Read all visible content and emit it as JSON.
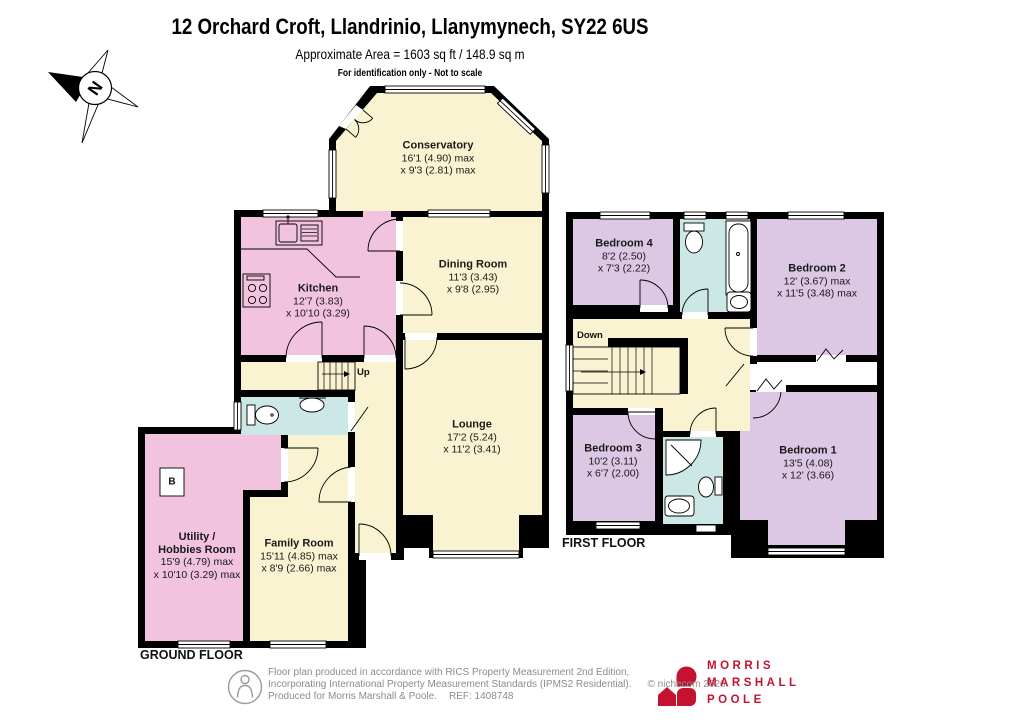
{
  "header": {
    "title": "12 Orchard Croft, Llandrinio, Llanymynech, SY22 6US",
    "area_line": "Approximate Area = 1603 sq ft / 148.9 sq m",
    "note": "For identification only - Not to scale"
  },
  "compass": {
    "label": "N"
  },
  "ground_floor": {
    "label": "GROUND FLOOR",
    "stairs_label": "Up",
    "boiler_label": "B",
    "rooms": {
      "conservatory": {
        "name": "Conservatory",
        "line1": "16'1 (4.90) max",
        "line2": "x 9'3 (2.81) max"
      },
      "kitchen": {
        "name": "Kitchen",
        "line1": "12'7 (3.83)",
        "line2": "x 10'10 (3.29)"
      },
      "dining_room": {
        "name": "Dining Room",
        "line1": "11'3 (3.43)",
        "line2": "x 9'8 (2.95)"
      },
      "lounge": {
        "name": "Lounge",
        "line1": "17'2 (5.24)",
        "line2": "x 11'2 (3.41)"
      },
      "utility_hobbies": {
        "name1": "Utility /",
        "name2": "Hobbies Room",
        "line1": "15'9 (4.79) max",
        "line2": "x 10'10 (3.29) max"
      },
      "family_room": {
        "name": "Family Room",
        "line1": "15'11 (4.85) max",
        "line2": "x 8'9 (2.66) max"
      }
    }
  },
  "first_floor": {
    "label": "FIRST FLOOR",
    "stairs_label": "Down",
    "rooms": {
      "bedroom_4": {
        "name": "Bedroom 4",
        "line1": "8'2 (2.50)",
        "line2": "x 7'3 (2.22)"
      },
      "bedroom_2": {
        "name": "Bedroom 2",
        "line1": "12' (3.67) max",
        "line2": "x 11'5 (3.48) max"
      },
      "bedroom_3": {
        "name": "Bedroom 3",
        "line1": "10'2 (3.11)",
        "line2": "x 6'7 (2.00)"
      },
      "bedroom_1": {
        "name": "Bedroom 1",
        "line1": "13'5 (4.08)",
        "line2": "x 12' (3.66)"
      }
    }
  },
  "footer": {
    "line1": "Floor plan produced in accordance with RICS Property Measurement 2nd Edition,",
    "line2": "Incorporating International Property Measurement Standards (IPMS2 Residential).",
    "copyright": "© nichecom 2026.",
    "produced": "Produced for Morris Marshall & Poole.",
    "ref": "REF: 1408748",
    "brand": {
      "line1": "MORRIS",
      "line2": "MARSHALL",
      "line3": "POOLE"
    }
  },
  "colors": {
    "cream": "#FAF3D1",
    "pink": "#F2C3DE",
    "purple": "#DCC7E4",
    "blue": "#CBE7E6",
    "wall": "#000000",
    "brand_red": "#C41230",
    "footer_grey": "#8C8C8C"
  }
}
